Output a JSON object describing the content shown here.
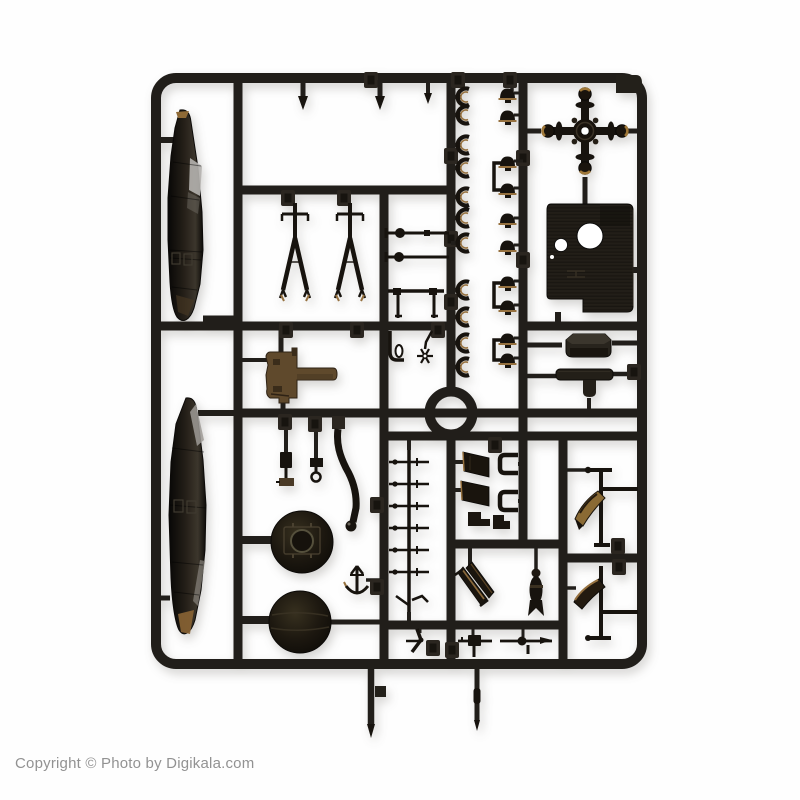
{
  "watermark": {
    "text": "Copyright © Photo by Digikala.com"
  },
  "colors": {
    "background": "#fefefe",
    "plastic": "#211e1a",
    "part": "#17130e",
    "tab_face": "#2b2620",
    "tab_inner": "#17140f",
    "tan": "#96713f",
    "amber": "#8a6434",
    "gold_blade": "#8a6a34",
    "gloss": "#b5b3af",
    "engine_brown": "#5f492c",
    "panel": "#201c16",
    "watermark_gray": "#929292"
  }
}
